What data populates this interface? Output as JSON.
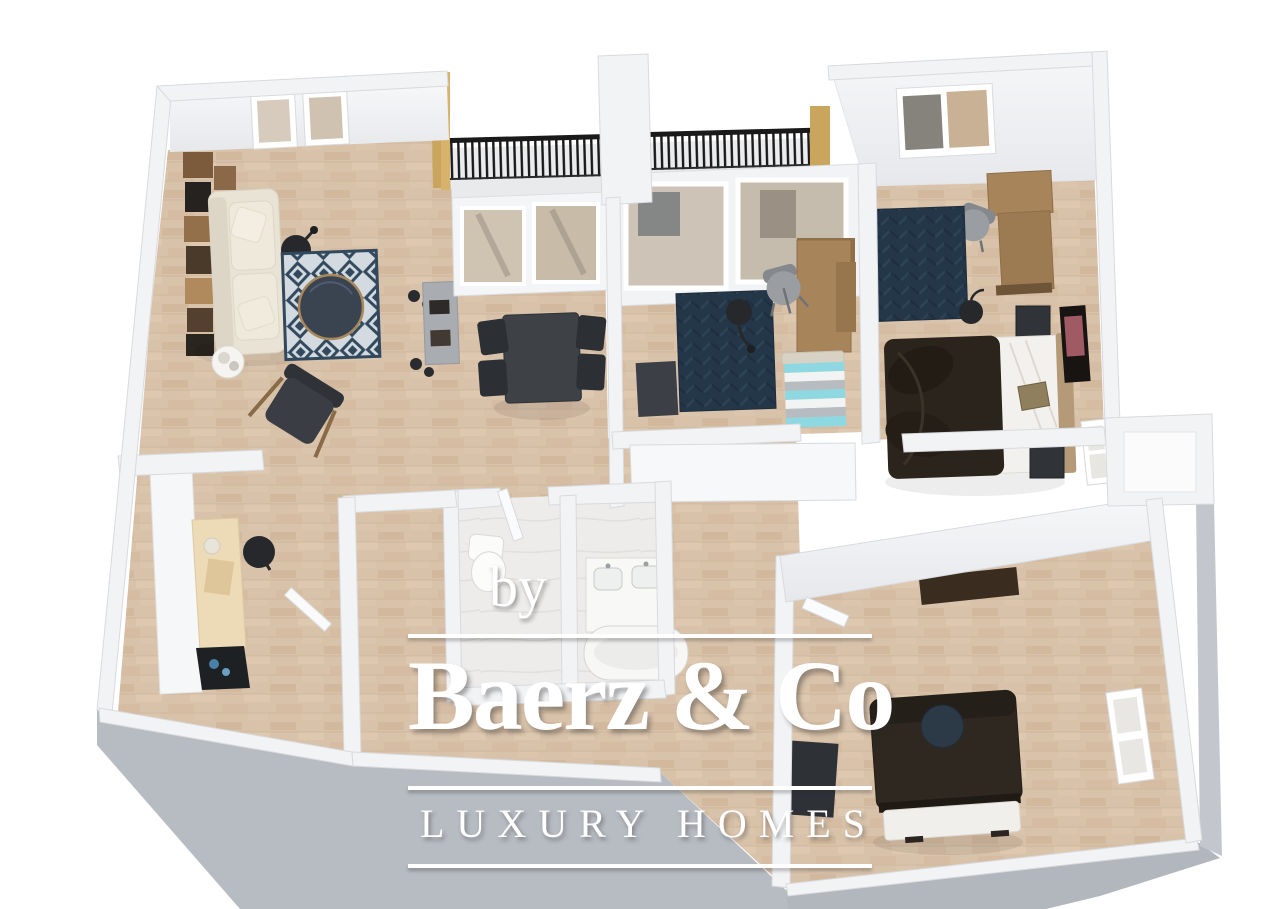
{
  "watermark": {
    "byline": "by",
    "brand": "Baerz & Co",
    "tagline": "LUXURY HOMES"
  },
  "colors": {
    "background": "#ffffff",
    "floor_parquet": "#d9c2aa",
    "bathroom_marble": "#edeceb",
    "wall_white": "#f2f3f5",
    "wall_side_gray": "#b7bbc2",
    "rug_navy": "#243749",
    "living_rug_blue": "#31485d",
    "sofa_cream": "#e9e3d5",
    "dining_black": "#3e4247",
    "desk_wood": "#a8845a",
    "bed_dark": "#2b241c",
    "bed_stripe_cyan": "#8ed8e2",
    "railing_black": "#1a1a1a",
    "wood_post": "#caa55e",
    "watermark_white": "#ffffff"
  }
}
